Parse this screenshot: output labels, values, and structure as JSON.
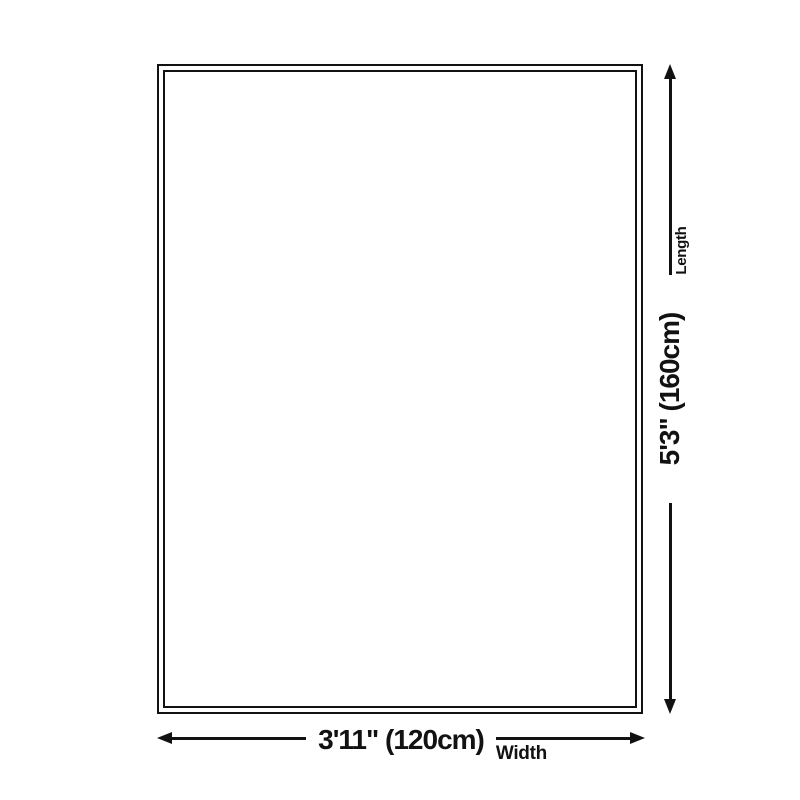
{
  "diagram": {
    "width_dimension": {
      "value": "3'11\" (120cm)",
      "axis_label": "Width"
    },
    "length_dimension": {
      "value": "5'3\" (160cm)",
      "axis_label": "Length"
    },
    "colors": {
      "outline": "#121212",
      "background": "#ffffff"
    }
  }
}
